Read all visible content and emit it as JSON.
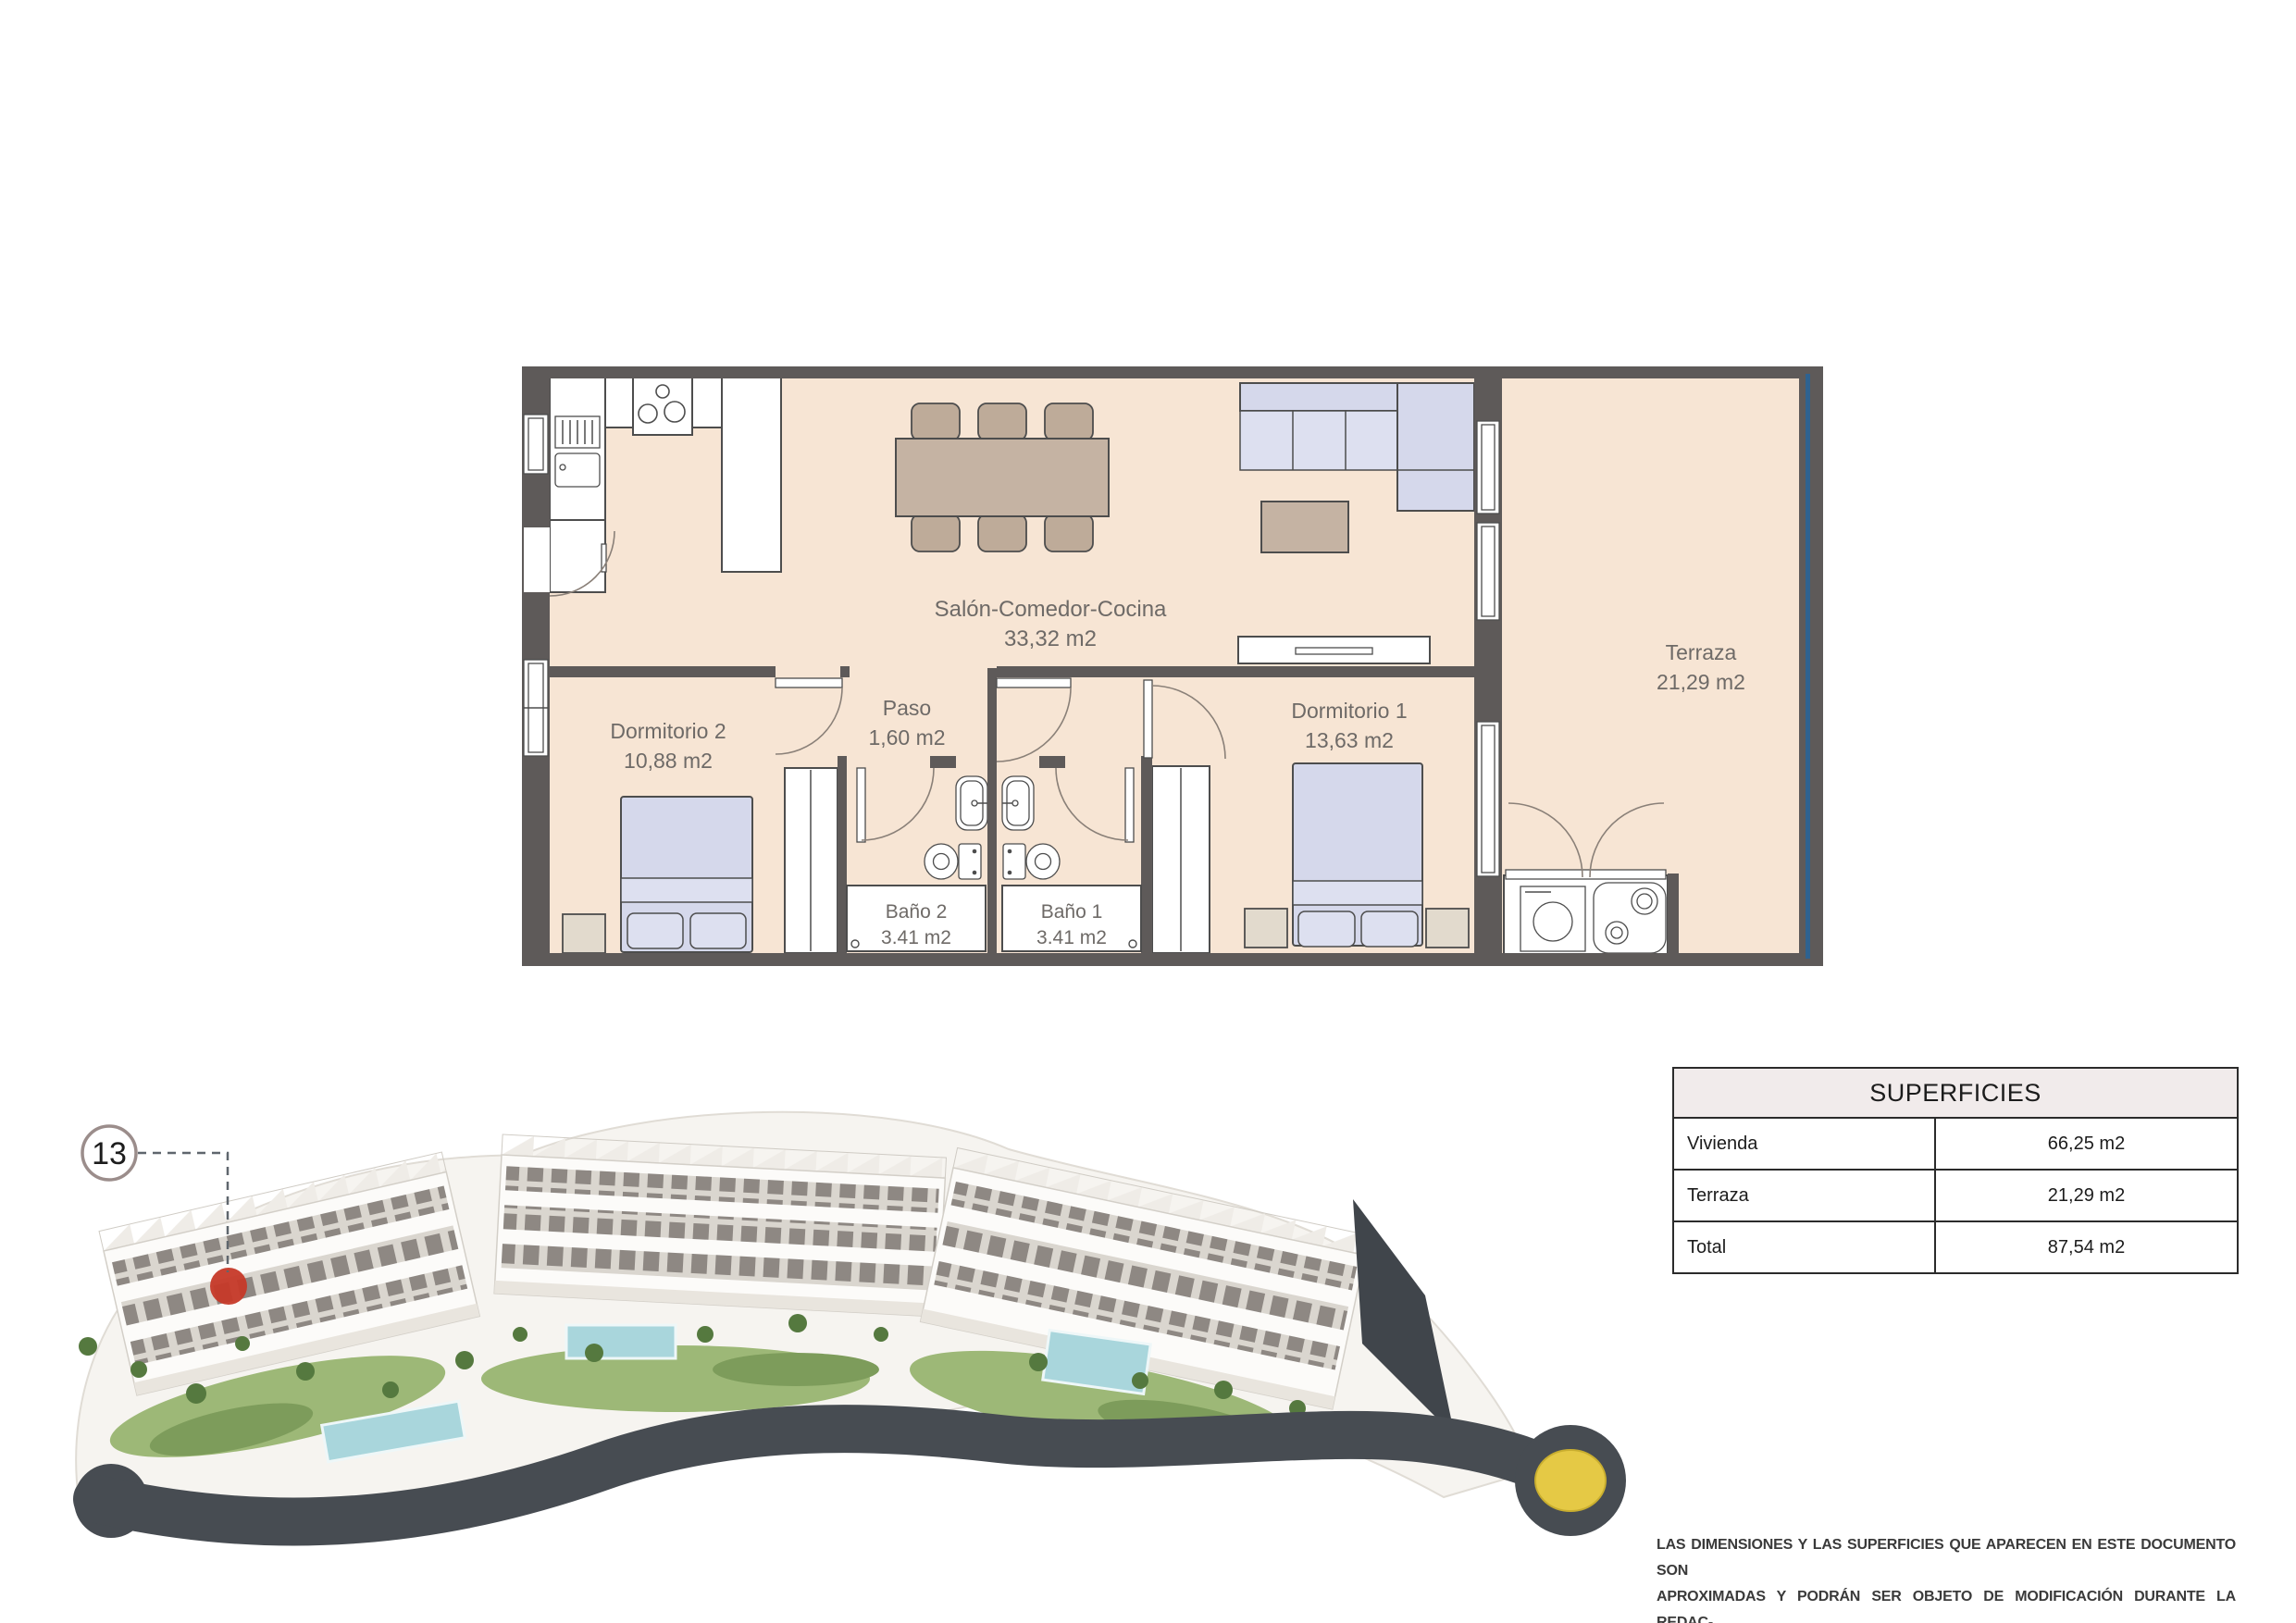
{
  "document": {
    "background": "#ffffff"
  },
  "floor_plan": {
    "rooms": [
      {
        "name": "Salón-Comedor-Cocina",
        "area": "33,32 m2"
      },
      {
        "name": "Paso",
        "area": "1,60 m2"
      },
      {
        "name": "Dormitorio 2",
        "area": "10,88 m2"
      },
      {
        "name": "Dormitorio 1",
        "area": "13,63 m2"
      },
      {
        "name": "Baño 2",
        "area": "3.41 m2"
      },
      {
        "name": "Baño 1",
        "area": "3.41 m2"
      },
      {
        "name": "Terraza",
        "area": "21,29 m2"
      }
    ],
    "colors": {
      "floor": "#f7e5d4",
      "wall": "#5e5a59",
      "furniture": "#d5d8eb",
      "wood": "#c5b3a3",
      "glass_railing": "#2e6290",
      "line": "#4d4d4d",
      "label_text": "#6e6a67"
    }
  },
  "site_plan": {
    "unit_number": "13",
    "marker_color": "#c63928",
    "roundabout_color": "#e5c945"
  },
  "superficies_table": {
    "title": "SUPERFICIES",
    "rows": [
      {
        "label": "Vivienda",
        "value": "66,25 m2"
      },
      {
        "label": "Terraza",
        "value": "21,29 m2"
      },
      {
        "label": "Total",
        "value": "87,54 m2"
      }
    ]
  },
  "disclaimer": {
    "lines": [
      "LAS DIMENSIONES Y LAS SUPERFICIES QUE APARECEN EN ESTE DOCUMENTO SON",
      "APROXIMADAS Y PODRÁN SER OBJETO DE MODIFICACIÓN DURANTE LA REDAC-",
      "CIÓN DE LOS PROYECTOS BÁSICO Y DE EJECUCIÓN"
    ]
  }
}
